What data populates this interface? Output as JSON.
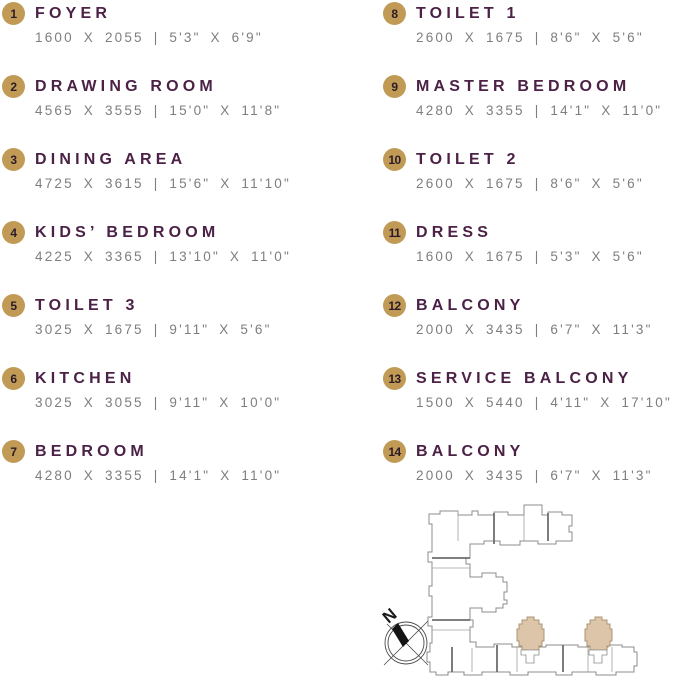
{
  "palette": {
    "badge_bg": "#C19B55",
    "badge_text": "#2B1B28",
    "room_title": "#4B2146",
    "dimensions_text": "#7E7E7E",
    "highlighted_unit_fill": "#DCC5A8",
    "highlighted_unit_stroke": "#AD9574",
    "building_outline": "#8C8C8C"
  },
  "legend": {
    "columns": [
      {
        "items": [
          {
            "num": "1",
            "name": "FOYER",
            "dims": "1600 X 2055 | 5'3\" X 6'9\""
          },
          {
            "num": "2",
            "name": "DRAWING ROOM",
            "dims": "4565 X 3555 | 15'0\" X 11'8\""
          },
          {
            "num": "3",
            "name": "DINING AREA",
            "dims": "4725 X 3615 | 15'6\" X 11'10\""
          },
          {
            "num": "4",
            "name": "KIDS’ BEDROOM",
            "dims": "4225 X 3365 | 13'10\" X 11'0\""
          },
          {
            "num": "5",
            "name": "TOILET 3",
            "dims": "3025 X 1675 | 9'11\" X 5'6\""
          },
          {
            "num": "6",
            "name": "KITCHEN",
            "dims": "3025 X 3055 | 9'11\" X 10'0\""
          },
          {
            "num": "7",
            "name": "BEDROOM",
            "dims": "4280 X 3355 | 14'1\" X 11'0\""
          }
        ]
      },
      {
        "items": [
          {
            "num": "8",
            "name": "TOILET 1",
            "dims": "2600 X 1675 | 8'6\" X 5'6\""
          },
          {
            "num": "9",
            "name": "MASTER BEDROOM",
            "dims": "4280 X 3355 | 14'1\" X 11'0\""
          },
          {
            "num": "10",
            "name": "TOILET 2",
            "dims": "2600 X 1675 | 8'6\" X 5'6\""
          },
          {
            "num": "11",
            "name": "DRESS",
            "dims": "1600 X 1675 | 5'3\" X 5'6\""
          },
          {
            "num": "12",
            "name": "BALCONY",
            "dims": "2000 X 3435 | 6'7\" X 11'3\""
          },
          {
            "num": "13",
            "name": "SERVICE BALCONY",
            "dims": "1500 X 5440 | 4'11\" X 17'10\""
          },
          {
            "num": "14",
            "name": "BALCONY",
            "dims": "2000 X 3435 | 6'7\" X 11'3\""
          }
        ]
      }
    ]
  },
  "site_plan": {
    "compass_label": "N",
    "highlighted_units_count": 2
  }
}
